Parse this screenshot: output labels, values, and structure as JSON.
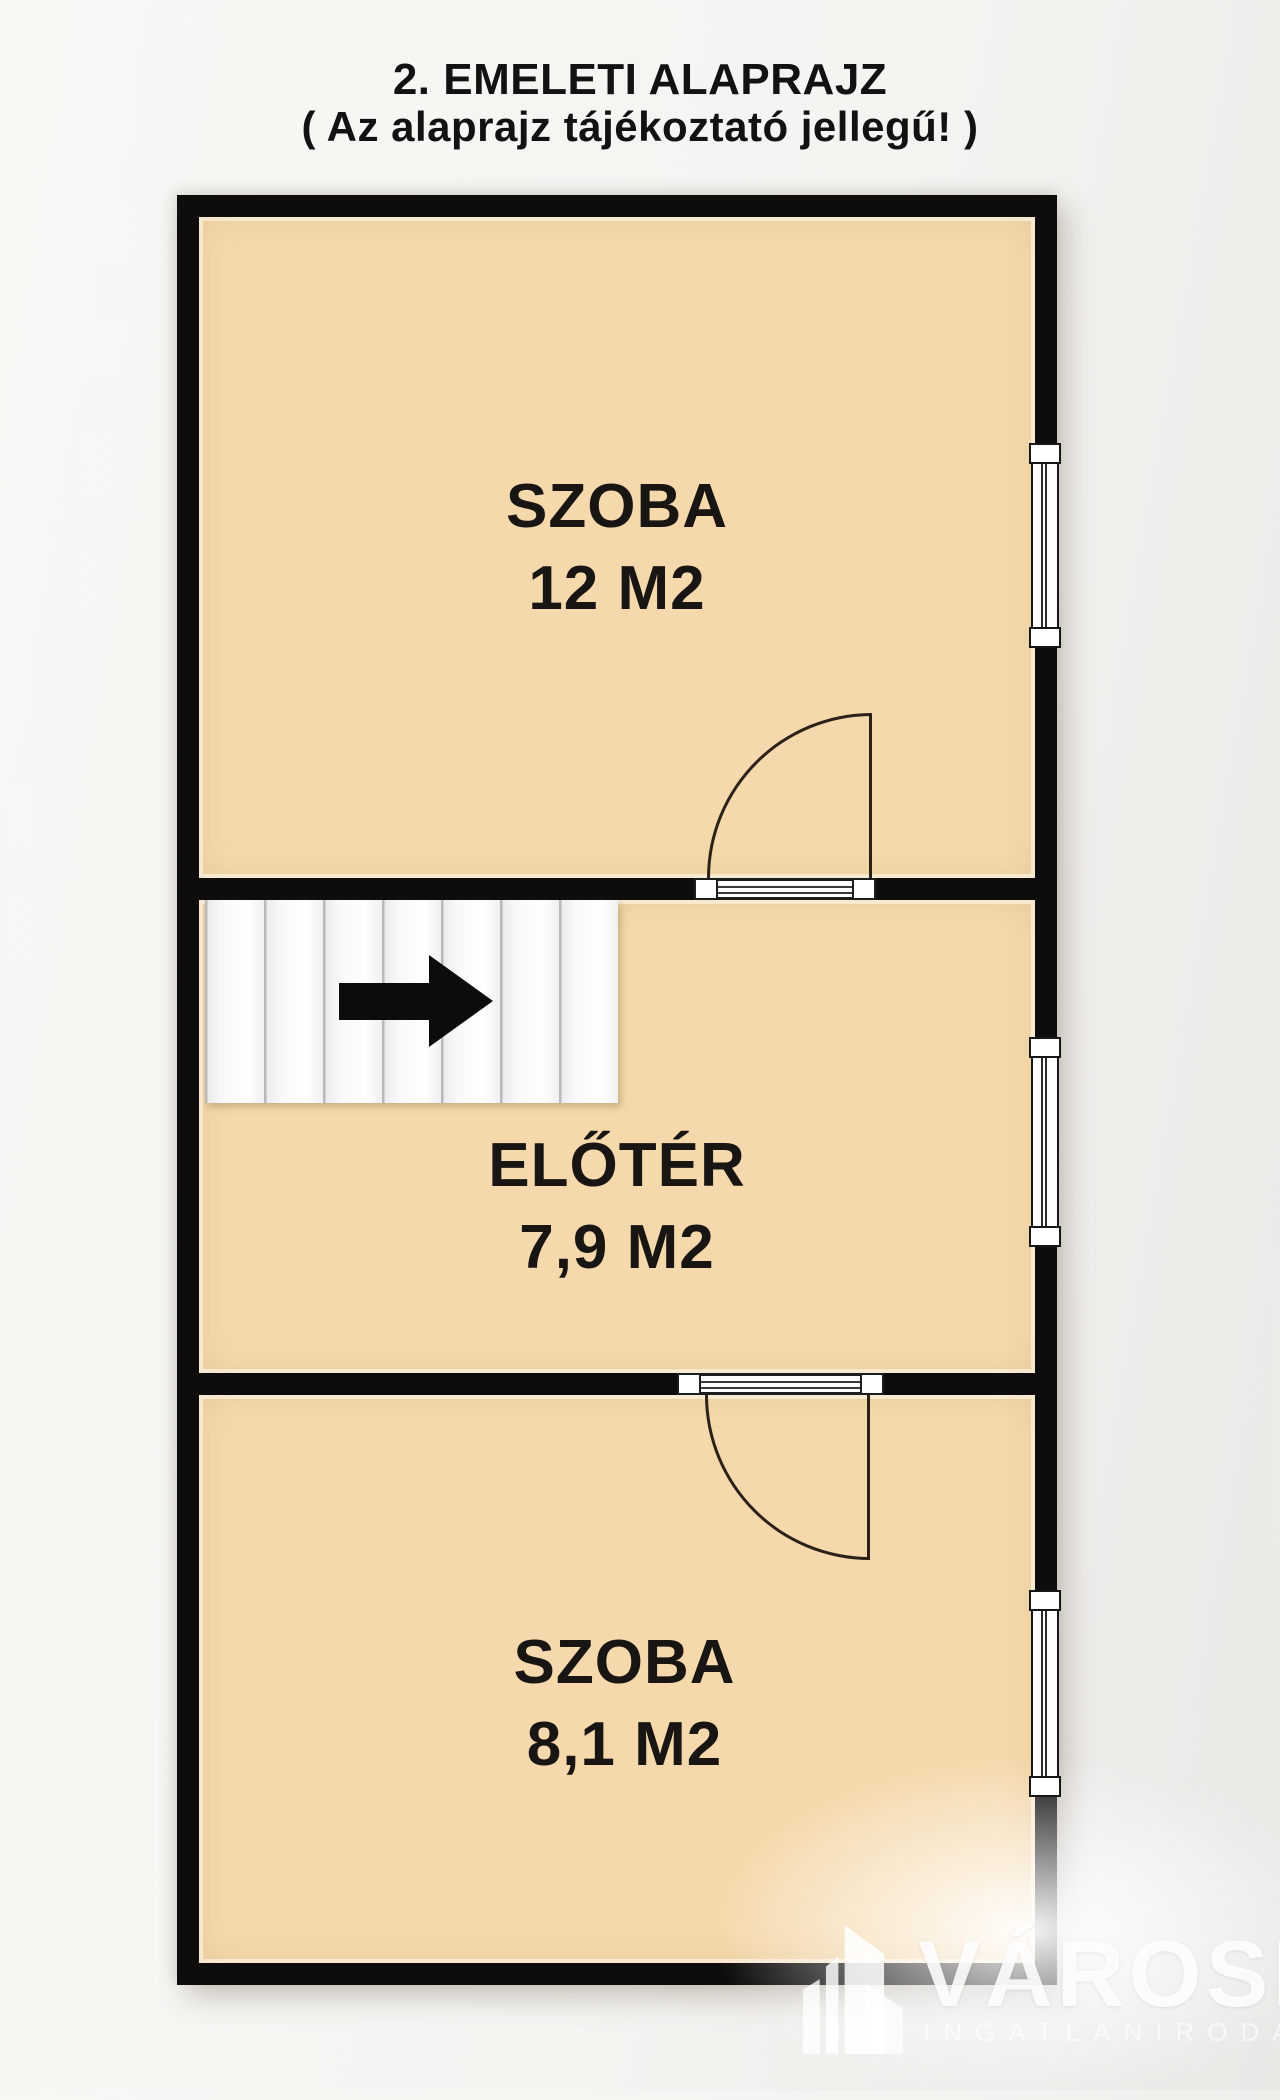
{
  "title": {
    "line1": "2. EMELETI ALAPRAJZ",
    "line2": "( Az alaprajz tájékoztató jellegű! )"
  },
  "floor_plan": {
    "rooms": [
      {
        "name": "SZOBA",
        "area": "12 M2"
      },
      {
        "name": "ELŐTÉR",
        "area": "7,9 M2"
      },
      {
        "name": "SZOBA",
        "area": "8,1 M2"
      }
    ],
    "features": {
      "windows": 3,
      "doors": 2,
      "stairs_steps": 7,
      "stairs_arrow_direction": "right"
    },
    "colors": {
      "room_fill": "#f5d9ac",
      "wall": "#0f0d0b",
      "background": "#f5f4f1"
    }
  },
  "watermark": {
    "brand": "VÁROSI",
    "tagline": "INGATLANIRODA"
  }
}
